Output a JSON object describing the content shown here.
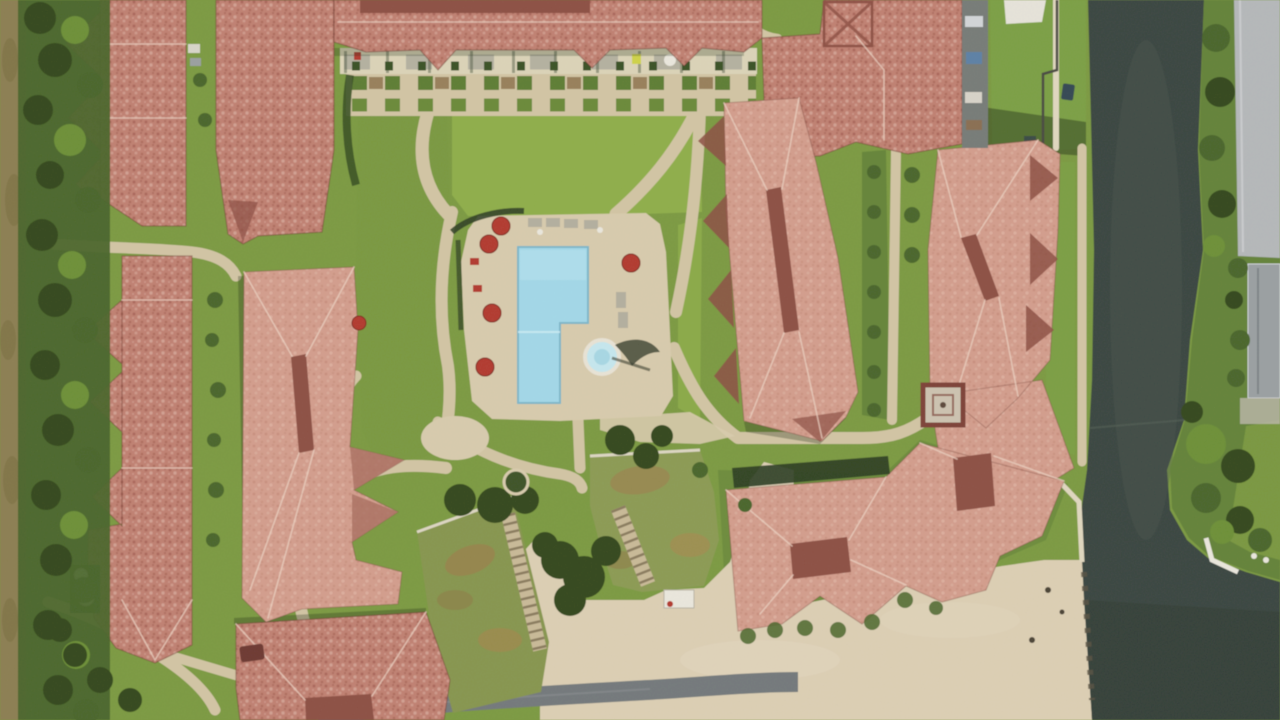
{
  "scene": {
    "description": "Aerial satellite view of a waterfront apartment complex: terracotta tile roofed buildings around a central courtyard with an L-shaped swimming pool, round hot tub and red patio umbrellas; green lawns crossed by tan walking paths and a planter promenade; a dark canal runs along the right edge with a tree-lined opposite bank, gray road and small dock; a sandy beach and dark access road line the bottom shore",
    "view": "top-down satellite imagery",
    "pool": {
      "shape": "L-shaped",
      "umbrella_count": 6,
      "has_hot_tub": true,
      "lounger_rows": 2
    },
    "water_body": "canal",
    "shore": "sandy beach with rock edge",
    "landmarks": {
      "gazebo": "square red-trimmed gazebo between center buildings",
      "green_roofs": "two vegetated roof terraces with staircases near the beach",
      "satellite_dishes": 2,
      "docks": 2
    },
    "palette": {
      "dirt": "#8c7f52",
      "treeDark": "#35491f",
      "treeMid": "#4b662c",
      "treeLight": "#6d9038",
      "grass": "#7c9a42",
      "grassBright": "#8fae4b",
      "grassDeep": "#64833a",
      "path": "#d2c5a4",
      "pathLight": "#e0d7bf",
      "deck": "#d8cbad",
      "sand": "#dccfb4",
      "sandLight": "#e4d8bf",
      "roofA": "#c08172",
      "roofB": "#d39e8d",
      "roofDark": "#a96e60",
      "ridge": "#8d5044",
      "pool": "#a3d8e8",
      "spa": "#c6e7ee",
      "water": "#3b4741",
      "waterLight": "#4d5a51",
      "road": "#b5b8ba",
      "roadDark": "#74797c",
      "umbrella": "#b23b30",
      "white": "#eae7dd",
      "shadow": "#243018",
      "stone": "#9aa0a2"
    }
  }
}
